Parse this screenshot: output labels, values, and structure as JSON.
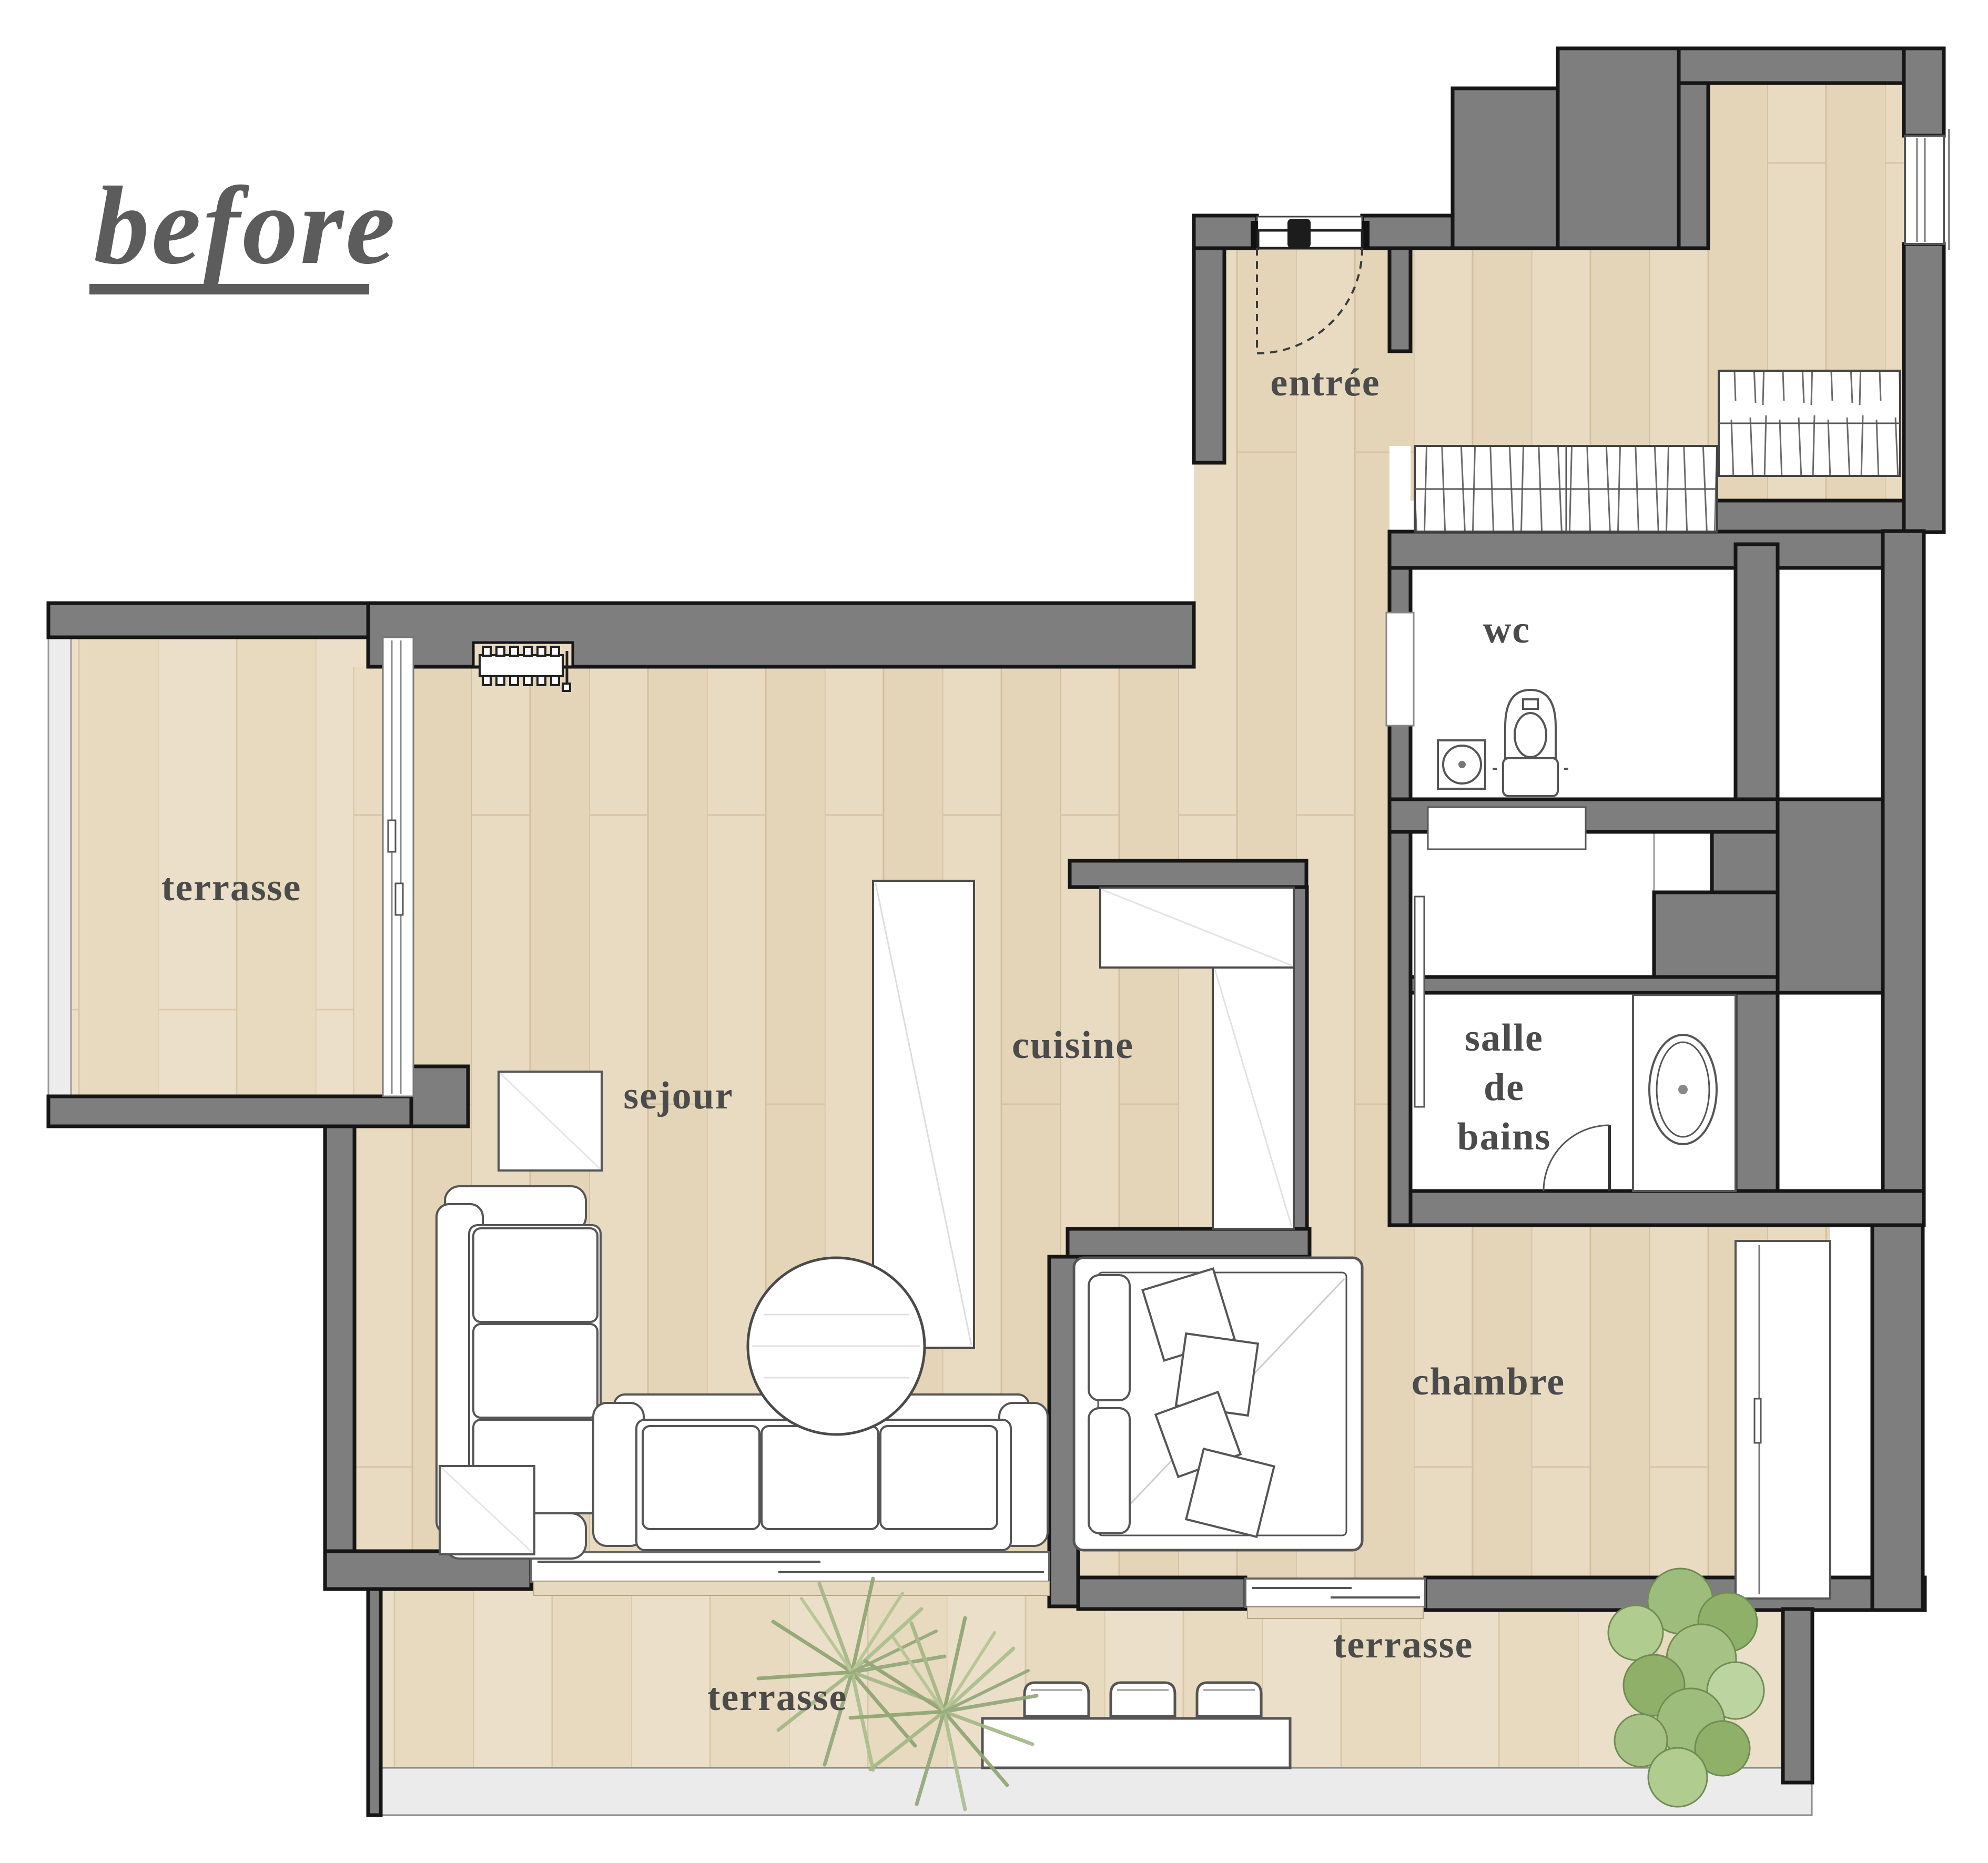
{
  "title": {
    "text": "before"
  },
  "rooms": [
    {
      "id": "terrasse-left",
      "label": "terrasse"
    },
    {
      "id": "sejour",
      "label": "sejour"
    },
    {
      "id": "cuisine",
      "label": "cuisine"
    },
    {
      "id": "entree",
      "label": "entrée"
    },
    {
      "id": "wc",
      "label": "wc"
    },
    {
      "id": "salle-de-bains",
      "label": "salle de bains",
      "lines": [
        "salle",
        "de",
        "bains"
      ]
    },
    {
      "id": "chambre",
      "label": "chambre"
    },
    {
      "id": "terrasse-bottom-left",
      "label": "terrasse"
    },
    {
      "id": "terrasse-bottom-right",
      "label": "terrasse"
    }
  ],
  "furniture": {
    "sejour": [
      "sofa-3-seat-vertical",
      "sofa-3-seat-horizontal",
      "round-coffee-table",
      "side-table",
      "side-table",
      "radiator"
    ],
    "cuisine": [
      "l-shaped-counter",
      "tall-cabinet"
    ],
    "entree": [
      "entrance-door-swing"
    ],
    "dressing": [
      "wardrobe-hatched",
      "wardrobe-hatched"
    ],
    "wc": [
      "toilet",
      "hand-basin"
    ],
    "salle_de_bains": [
      "vanity-counter",
      "oval-washbasin",
      "door-swing"
    ],
    "chambre": [
      "double-bed",
      "pillows",
      "cushions",
      "wardrobe"
    ],
    "terrasse": [
      "dining-table",
      "chair",
      "chair",
      "chair",
      "palm-plant",
      "palm-plant",
      "leafy-plant"
    ]
  },
  "colors": {
    "wall": "#7e7e7e",
    "wall_outline": "#161616",
    "floor_wood": "#e8dac0",
    "floor_plank_line": "#d2bf9f",
    "terrace_wood": "#ebdfca",
    "white_room": "#ffffff",
    "fixture_outline": "#5a5a5a",
    "text": "#4b4b4b",
    "rail": "#ececec",
    "plant_dark": "#7f9a5e",
    "plant_mid": "#9ab977",
    "plant_light": "#b9d29c"
  }
}
